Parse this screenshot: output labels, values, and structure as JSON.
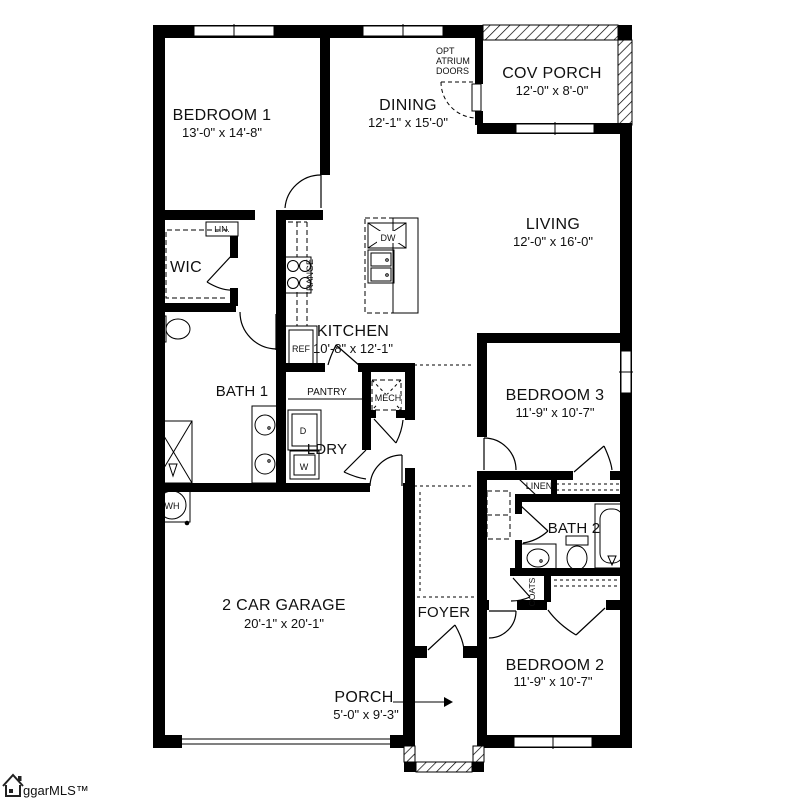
{
  "plan": {
    "rooms": {
      "bedroom1": {
        "name": "BEDROOM 1",
        "dims": "13'-0\" x 14'-8\""
      },
      "dining": {
        "name": "DINING",
        "dims": "12'-1\" x 15'-0\""
      },
      "cov_porch": {
        "name": "COV PORCH",
        "dims": "12'-0\" x 8'-0\""
      },
      "living": {
        "name": "LIVING",
        "dims": "12'-0\" x 16'-0\""
      },
      "wic": {
        "name": "WIC"
      },
      "kitchen": {
        "name": "KITCHEN",
        "dims": "10'-8\" x 12'-1\""
      },
      "bath1": {
        "name": "BATH 1"
      },
      "ldry": {
        "name": "LDRY"
      },
      "bedroom3": {
        "name": "BEDROOM 3",
        "dims": "11'-9\" x 10'-7\""
      },
      "bath2": {
        "name": "BATH 2"
      },
      "bedroom2": {
        "name": "BEDROOM 2",
        "dims": "11'-9\" x 10'-7\""
      },
      "garage": {
        "name": "2 CAR GARAGE",
        "dims": "20'-1\" x 20'-1\""
      },
      "foyer": {
        "name": "FOYER"
      },
      "porch": {
        "name": "PORCH",
        "dims": "5'-0\" x 9'-3\""
      }
    },
    "closets": {
      "lin": "LIN.",
      "linen": "LINEN",
      "coats": "COATS",
      "pantry": "PANTRY",
      "mech": "MECH"
    },
    "fixtures": {
      "range": "RANGE",
      "ref": "REF",
      "dw": "DW",
      "dryer": "D",
      "washer": "W",
      "water_heater": "WH"
    },
    "annotations": {
      "opt_atrium_line1": "OPT",
      "opt_atrium_line2": "ATRIUM",
      "opt_atrium_line3": "DOORS"
    },
    "branding": {
      "logo_text": "ggarMLS™"
    },
    "colors": {
      "wall": "#000000",
      "background": "#ffffff",
      "text": "#101010"
    }
  }
}
